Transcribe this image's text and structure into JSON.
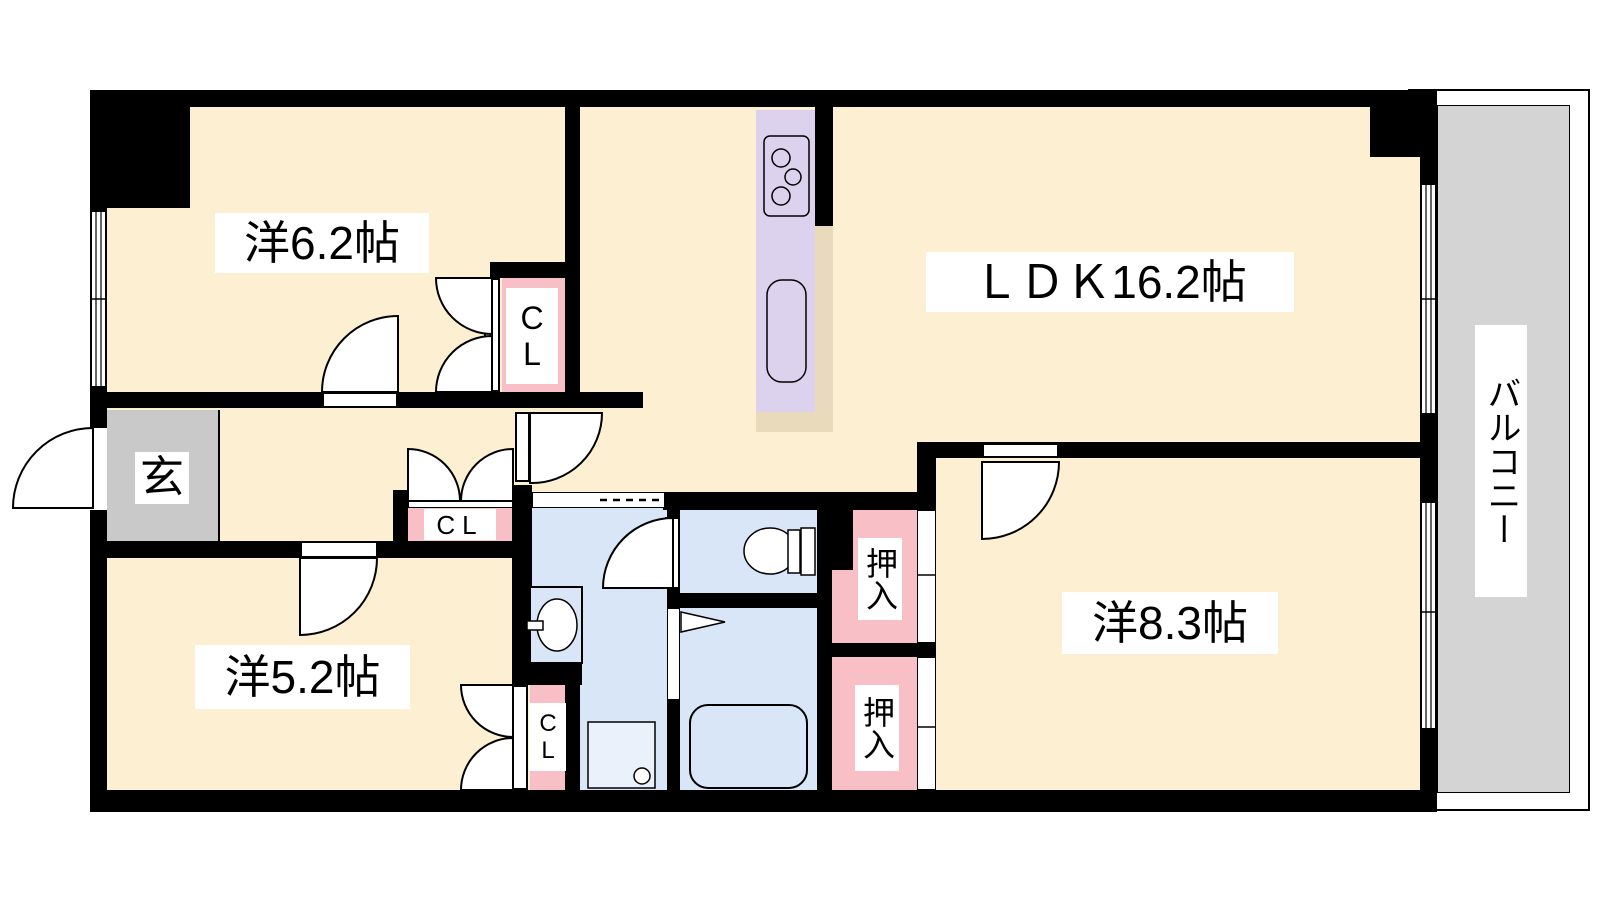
{
  "floorplan": {
    "type": "japanese-apartment-floorplan",
    "rooms": [
      {
        "id": "western-room-6-2",
        "label": "洋6.2帖"
      },
      {
        "id": "ldk",
        "label": "ＬＤＫ16.2帖"
      },
      {
        "id": "western-room-5-2",
        "label": "洋5.2帖"
      },
      {
        "id": "western-room-8-3",
        "label": "洋8.3帖"
      },
      {
        "id": "entrance",
        "label": "玄"
      },
      {
        "id": "balcony",
        "label": "バルコニー"
      }
    ],
    "storage": {
      "closet_label": "CL",
      "oshiire_label": "押入"
    },
    "colors": {
      "wall": "#000000",
      "floor": "#fdf0d2",
      "water_area": "#d8e6f7",
      "closet": "#f9bfc6",
      "kitchen_counter": "#dcd2ed",
      "counter_edge": "#e8dabb",
      "balcony_floor": "#d4d4d4",
      "entrance_floor": "#c9c9c9",
      "label_bg": "#ffffff"
    }
  }
}
